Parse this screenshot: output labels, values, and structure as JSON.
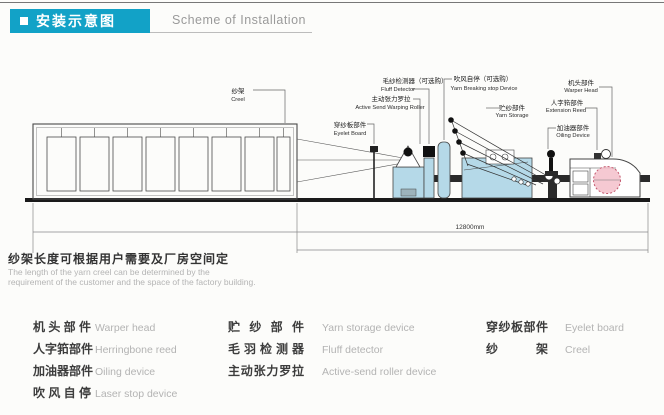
{
  "title": {
    "cn": "安装示意图",
    "en": "Scheme of Installation"
  },
  "colors": {
    "accent": "#12a2c7",
    "machine_blue": "#b5d9e8",
    "beam_pink": "#f3bfca"
  },
  "diagram": {
    "dimension": "12800mm",
    "labels": {
      "creel": {
        "cn": "纱架",
        "en": "Creel"
      },
      "eyelet": {
        "cn": "穿纱板部件",
        "en": "Eyelet Board"
      },
      "roller": {
        "cn": "主动张力罗拉",
        "en": "Active Send Warping Roller"
      },
      "fluff": {
        "cn": "毛纱检测器（可选购）",
        "en": "Fluff Detector"
      },
      "stop": {
        "cn": "吹风自停（可选购）",
        "en": "Yarn Breaking stop Device"
      },
      "storage": {
        "cn": "贮纱部件",
        "en": "Yarn Storage"
      },
      "warper": {
        "cn": "机头部件",
        "en": "Warper Head"
      },
      "reed": {
        "cn": "人字筘部件",
        "en": "Extension Reed"
      },
      "oiling": {
        "cn": "加油器部件",
        "en": "Oiling Device"
      }
    }
  },
  "note": {
    "cn": "纱架长度可根据用户需要及厂房空间定",
    "en1": "The length of the yarn creel can be determined by the",
    "en2": "requirement of the customer and the space of the factory building."
  },
  "legend": {
    "col1": [
      {
        "cn": "机头部件",
        "en": "Warper head"
      },
      {
        "cn": "人字筘部件",
        "en": "Herringbone reed"
      },
      {
        "cn": "加油器部件",
        "en": "Oiling device"
      },
      {
        "cn": "吹风自停",
        "en": "Laser stop device"
      }
    ],
    "col2": [
      {
        "cn": "贮纱部件",
        "en": "Yarn storage device"
      },
      {
        "cn": "毛羽检测器",
        "en": "Fluff detector"
      },
      {
        "cn": "主动张力罗拉",
        "en": "Active-send roller device"
      }
    ],
    "col3": [
      {
        "cn": "穿纱板部件",
        "en": "Eyelet board"
      },
      {
        "cn": "纱架",
        "en": "Creel"
      }
    ]
  }
}
